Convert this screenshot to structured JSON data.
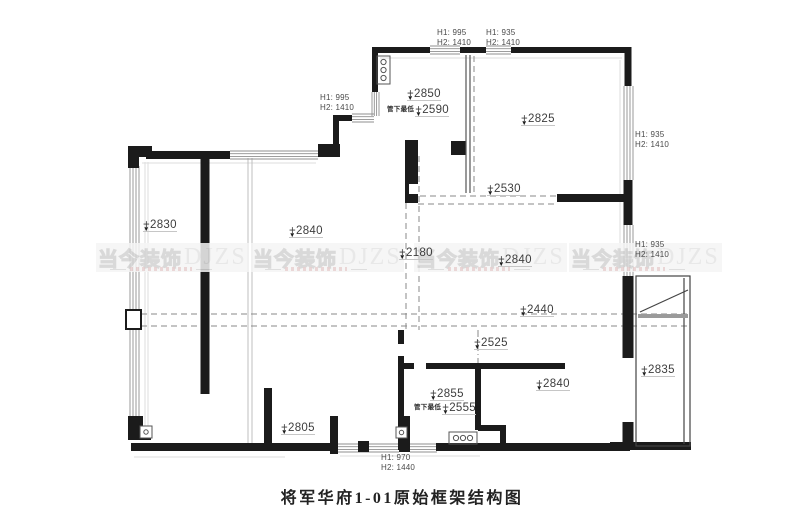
{
  "drawing": {
    "title": "将军华府1-01原始框架结构图"
  },
  "watermark": {
    "cn": "当今装饰",
    "en": "DJZS",
    "instances": [
      {
        "x": 96,
        "y": 243
      },
      {
        "x": 251,
        "y": 243
      },
      {
        "x": 414,
        "y": 243
      },
      {
        "x": 569,
        "y": 243
      }
    ]
  },
  "elevation_markers": [
    {
      "value": "+2830",
      "x": 143,
      "y": 219
    },
    {
      "value": "+2840",
      "x": 289,
      "y": 225
    },
    {
      "value": "+2850",
      "x": 407,
      "y": 88
    },
    {
      "value": "+2590",
      "x": 387,
      "y": 103,
      "note": "管下最低"
    },
    {
      "value": "+2825",
      "x": 521,
      "y": 113
    },
    {
      "value": "+2530",
      "x": 487,
      "y": 183
    },
    {
      "value": "+2180",
      "x": 399,
      "y": 247
    },
    {
      "value": "+2840",
      "x": 498,
      "y": 254
    },
    {
      "value": "+2440",
      "x": 520,
      "y": 304
    },
    {
      "value": "+2525",
      "x": 474,
      "y": 337
    },
    {
      "value": "+2855",
      "x": 430,
      "y": 388
    },
    {
      "value": "+2555",
      "x": 414,
      "y": 401,
      "note": "管下最低"
    },
    {
      "value": "+2840",
      "x": 536,
      "y": 378
    },
    {
      "value": "+2835",
      "x": 641,
      "y": 364
    },
    {
      "value": "+2805",
      "x": 281,
      "y": 422
    }
  ],
  "dimension_labels": [
    {
      "h1": "H1: 995",
      "h2": "H2: 1410",
      "x": 320,
      "y": 93
    },
    {
      "h1": "H1: 995",
      "h2": "H2: 1410",
      "x": 437,
      "y": 28
    },
    {
      "h1": "H1: 935",
      "h2": "H2: 1410",
      "x": 486,
      "y": 28
    },
    {
      "h1": "H1: 935",
      "h2": "H2: 1410",
      "x": 635,
      "y": 130
    },
    {
      "h1": "H1: 935",
      "h2": "H2: 1410",
      "x": 635,
      "y": 240
    },
    {
      "h1": "H1: 970",
      "h2": "H2: 1440",
      "x": 381,
      "y": 453
    }
  ]
}
